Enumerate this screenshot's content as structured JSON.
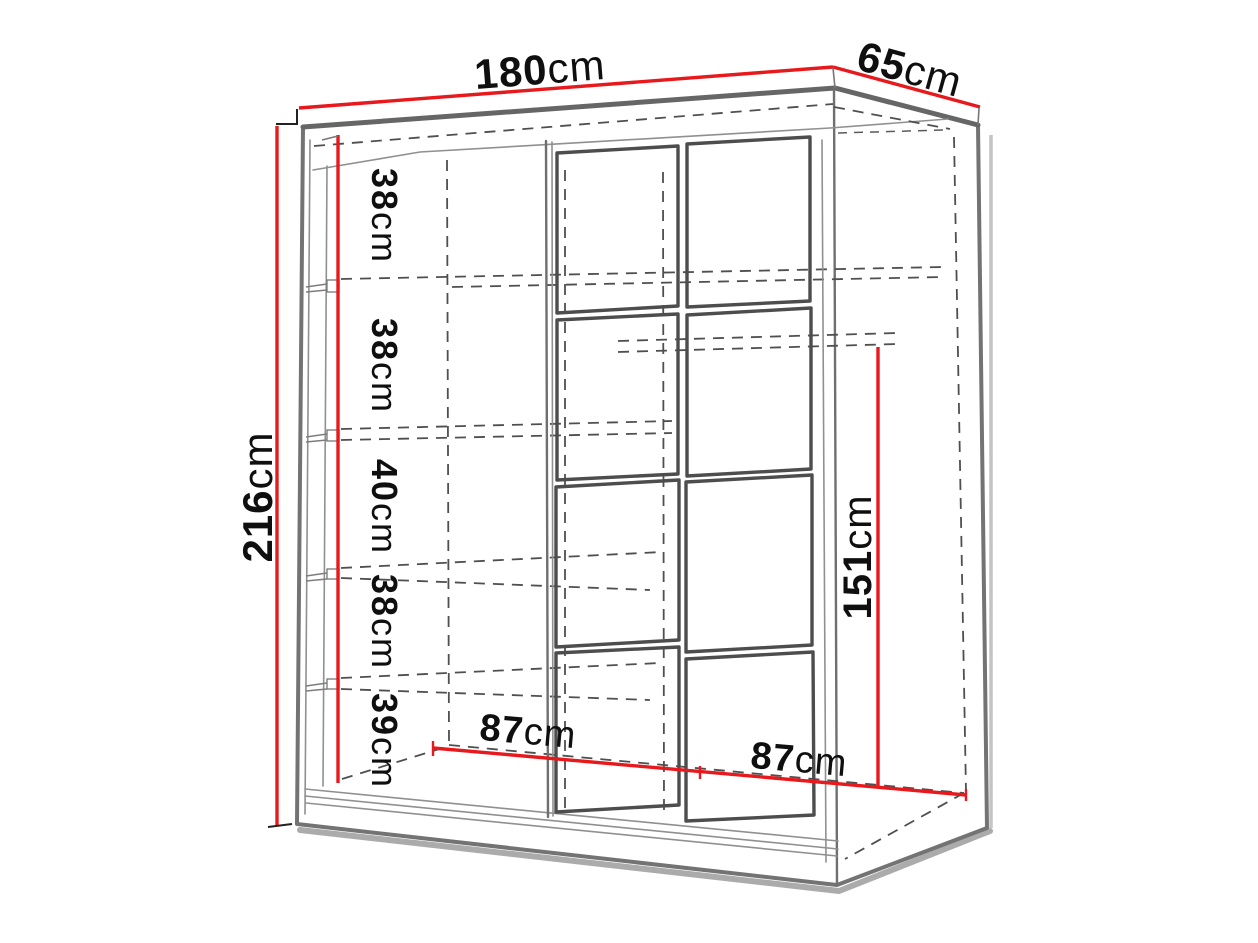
{
  "diagram": {
    "subject": "Sliding-door wardrobe — dimensioned 3D line drawing",
    "units": "cm",
    "overall": {
      "width": {
        "number": "180",
        "unit": "cm"
      },
      "depth": {
        "number": "65",
        "unit": "cm"
      },
      "height": {
        "number": "216",
        "unit": "cm"
      }
    },
    "interior": {
      "shelf_sections_top_to_bottom": [
        {
          "number": "38",
          "unit": "cm"
        },
        {
          "number": "38",
          "unit": "cm"
        },
        {
          "number": "40",
          "unit": "cm"
        },
        {
          "number": "38",
          "unit": "cm"
        },
        {
          "number": "39",
          "unit": "cm"
        }
      ],
      "hanging_space_height": {
        "number": "151",
        "unit": "cm"
      },
      "door_section_widths": [
        {
          "number": "87",
          "unit": "cm"
        },
        {
          "number": "87",
          "unit": "cm"
        }
      ]
    },
    "colors": {
      "dimension_line": "#e8191c",
      "outline": "#737373",
      "panel_frame": "#4d4d4d",
      "hidden_line": "#4f4f4f",
      "text": "#0f0f0f",
      "background": "#ffffff"
    }
  }
}
